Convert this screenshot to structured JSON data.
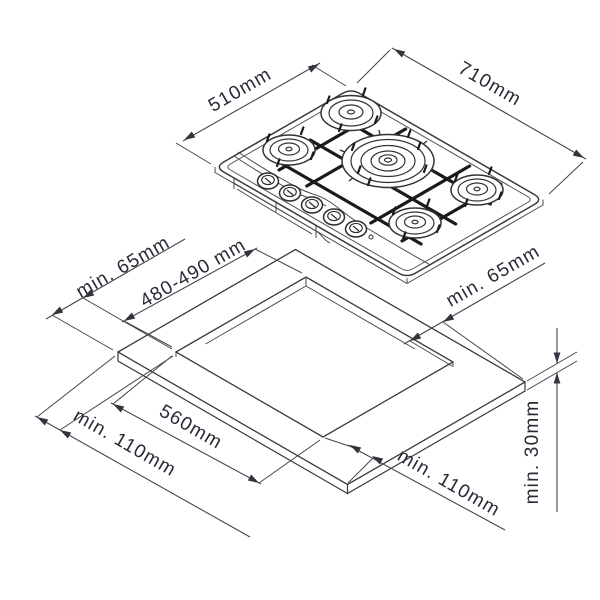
{
  "diagram": {
    "hob": {
      "dim_depth_label": "510mm",
      "dim_width_label": "710mm",
      "burner_count": 5,
      "knob_count": 5
    },
    "worktop": {
      "cutout_depth_label": "480-490 mm",
      "cutout_width_label": "560mm",
      "clearance_side_left_label": "min. 65mm",
      "clearance_side_right_label": "min. 65mm",
      "clearance_front_left_label": "min. 110mm",
      "clearance_front_right_label": "min. 110mm",
      "thickness_label": "min. 30mm"
    },
    "colors": {
      "line": "#3a3a3a",
      "grate": "#1a1a1a",
      "label_text": "#272b36",
      "background": "#ffffff"
    }
  }
}
